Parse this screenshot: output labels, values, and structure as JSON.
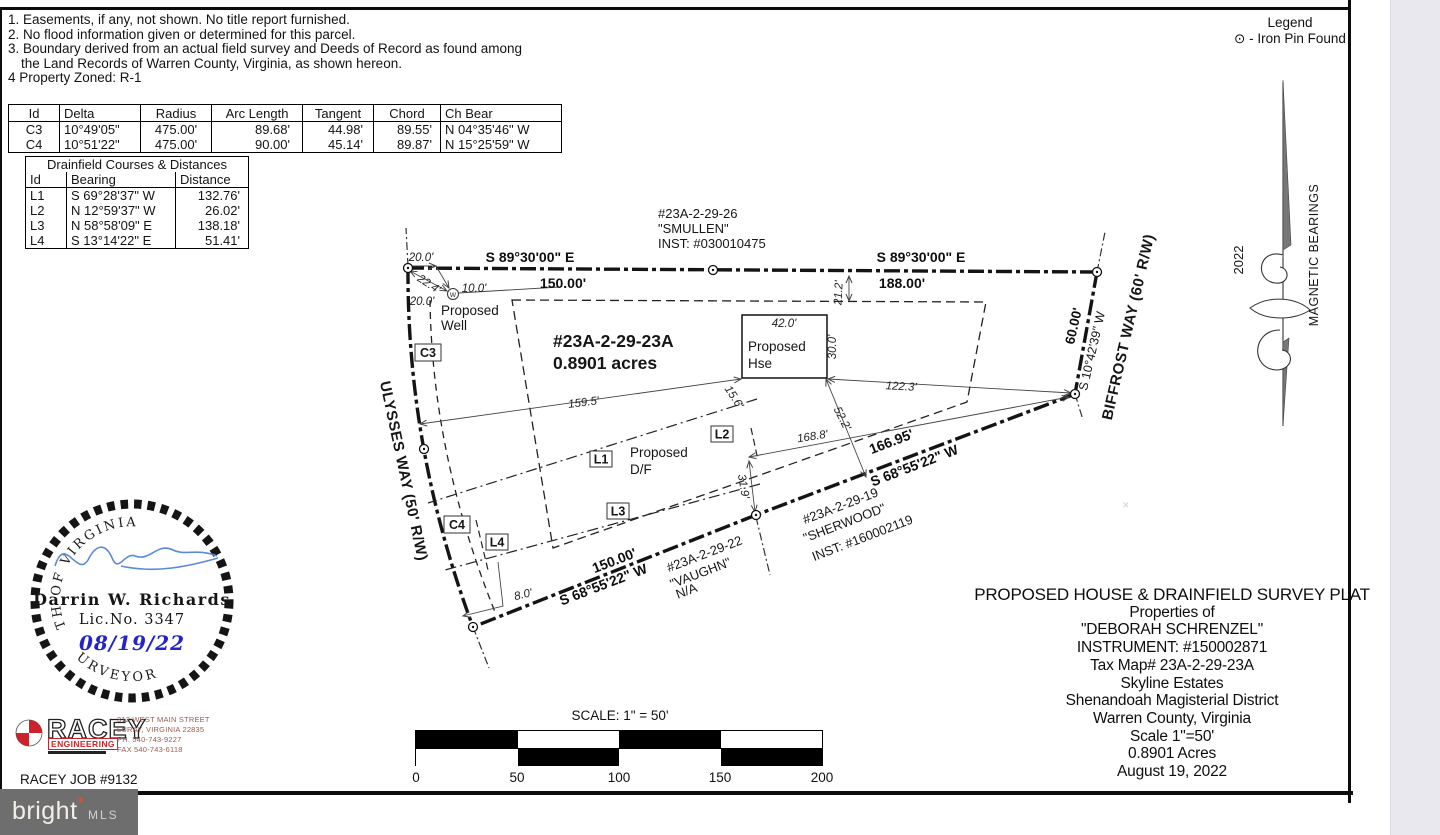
{
  "notes": {
    "lines": [
      "1. Easements, if any, not shown. No title report furnished.",
      "2. No flood information given or determined for this parcel.",
      "3. Boundary derived from an actual field survey and Deeds of Record as found among",
      "the Land Records of Warren County, Virginia, as shown hereon.",
      "4 Property Zoned: R-1"
    ]
  },
  "curve": {
    "headers": [
      "Id",
      "Delta",
      "Radius",
      "Arc Length",
      "Tangent",
      "Chord",
      "Ch Bear"
    ],
    "rows": [
      {
        "id": "C3",
        "delta": "10°49'05\"",
        "radius": "475.00'",
        "arc": "89.68'",
        "tangent": "44.98'",
        "chord": "89.55'",
        "bear": "N 04°35'46\" W"
      },
      {
        "id": "C4",
        "delta": "10°51'22\"",
        "radius": "475.00'",
        "arc": "90.00'",
        "tangent": "45.14'",
        "chord": "89.87'",
        "bear": "N 15°25'59\" W"
      }
    ]
  },
  "drainfield": {
    "title": "Drainfield Courses & Distances",
    "headers": [
      "Id",
      "Bearing",
      "Distance"
    ],
    "rows": [
      {
        "id": "L1",
        "bearing": "S 69°28'37\" W",
        "dist": "132.76'"
      },
      {
        "id": "L2",
        "bearing": "N 12°59'37\" W",
        "dist": "26.02'"
      },
      {
        "id": "L3",
        "bearing": "N 58°58'09\" E",
        "dist": "138.18'"
      },
      {
        "id": "L4",
        "bearing": "S 13°14'22\" E",
        "dist": "51.41'"
      }
    ]
  },
  "legend": {
    "title": "Legend",
    "symbol": "⊙",
    "item": "- Iron Pin Found"
  },
  "north": {
    "year": "2022",
    "label": "MAGNETIC BEARINGS"
  },
  "plat": {
    "smullen1": "#23A-2-29-26",
    "smullen2": "\"SMULLEN\"",
    "smullen3": "INST: #030010475",
    "bearing_top": "S 89°30'00\" E",
    "dist150": "150.00'",
    "dist188": "188.00'",
    "parcel_id": "#23A-2-29-23A",
    "parcel_area": "0.8901 acres",
    "well1": "Proposed",
    "well2": "Well",
    "well_w": "W",
    "d20a": "20.0'",
    "d224": "22.4'",
    "d10": "10.0'",
    "d20b": "20.0'",
    "house_w": "42.0'",
    "house1": "Proposed",
    "house2": "Hse",
    "house_d": "30.0'",
    "d212": "21.2'",
    "d1223": "122.3'",
    "d1595": "159.5'",
    "d156": "15.6'",
    "d522": "52.2'",
    "d1688": "168.8'",
    "d319": "31.9'",
    "d80": "8.0'",
    "biffrost": "BIFFROST WAY (60' R/W)",
    "d60": "60.00'",
    "bearing_biffrost": "S 10°42'39\" W",
    "ulysses": "ULYSSES WAY (50' R/W)",
    "bearing_south": "S 68°55'22\" W",
    "d16695": "166.95'",
    "south_dist": "150.00'",
    "df1": "Proposed",
    "df2": "D/F",
    "c3": "C3",
    "c4": "C4",
    "l1": "L1",
    "l2": "L2",
    "l3": "L3",
    "l4": "L4",
    "vaughn1": "#23A-2-29-22",
    "vaughn2": "\"VAUGHN\"",
    "vaughn3": "N/A",
    "sher1": "#23A-2-29-19",
    "sher2": "\"SHERWOOD\"",
    "sher3": "INST: #160002119"
  },
  "seal": {
    "arc_top": "COMMONWEALTH OF VIRGINIA",
    "arc_bottom": "LAND SURVEYOR",
    "name": "Darrin W. Richards",
    "lic": "Lic.No.  3347",
    "date": "08/19/22"
  },
  "racey": {
    "name": "RACEY",
    "eng": "ENGINEERING",
    "addr1": "312 WEST MAIN STREET",
    "addr2": "LURAY, VIRGINIA 22835",
    "addr3": "PH. 540-743-9227",
    "addr4": "FAX 540-743-6118",
    "job": "RACEY JOB #9132"
  },
  "scale": {
    "title": "SCALE: 1\" = 50'",
    "ticks": [
      "0",
      "50",
      "100",
      "150",
      "200"
    ]
  },
  "titleblock": {
    "lines": [
      "PROPOSED HOUSE & DRAINFIELD SURVEY PLAT",
      "Properties of",
      "\"DEBORAH SCHRENZEL\"",
      "INSTRUMENT: #150002871",
      "Tax Map# 23A-2-29-23A",
      "Skyline Estates",
      "Shenandoah Magisterial District",
      "Warren County, Virginia",
      "Scale 1\"=50'",
      "0.8901 Acres",
      "August 19, 2022"
    ]
  },
  "footer": {
    "brand": "bright",
    "suffix": "MLS",
    "star": "✶"
  },
  "misc": {
    "stray_mark": "✕"
  },
  "colors": {
    "date_blue": "#2323cc",
    "signature_blue": "#5b8bd8",
    "racey_red": "#cc2229",
    "footer_grey": "#6e6e6e",
    "margin_grey": "#e8e8ee"
  }
}
